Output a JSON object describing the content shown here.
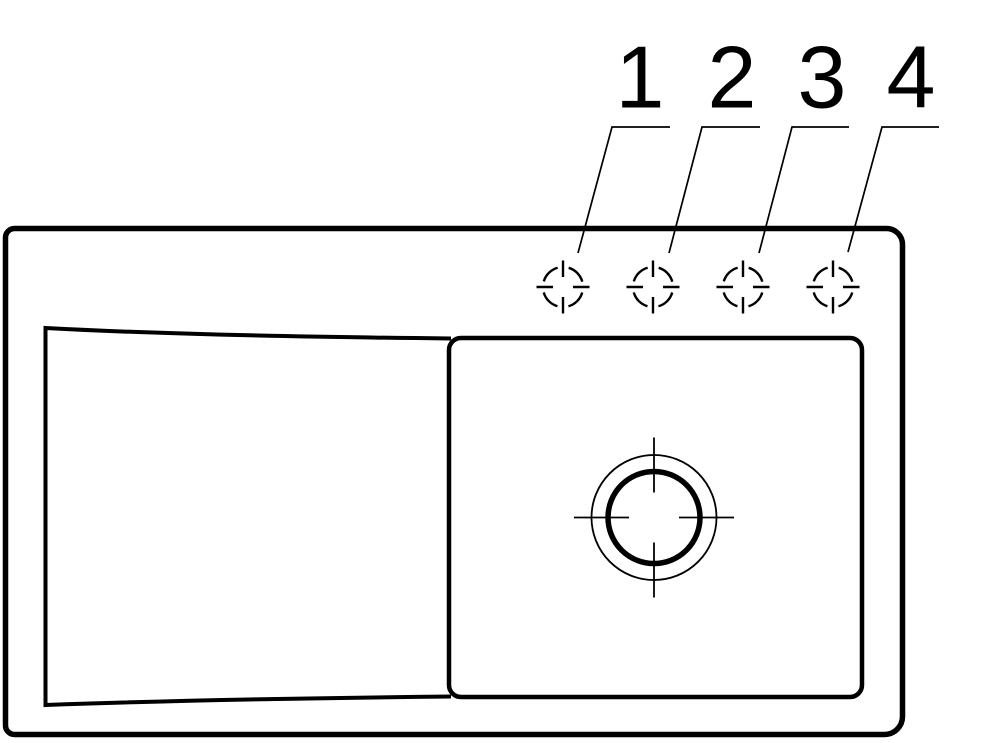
{
  "drawing": {
    "kind": "technical line drawing",
    "subject": "sink top view with drainboard, bowl, drain outlet and four tap hole positions",
    "colors": {
      "line": "#000000",
      "background": "#ffffff"
    }
  },
  "callouts": [
    {
      "number": "1"
    },
    {
      "number": "2"
    },
    {
      "number": "3"
    },
    {
      "number": "4"
    }
  ]
}
